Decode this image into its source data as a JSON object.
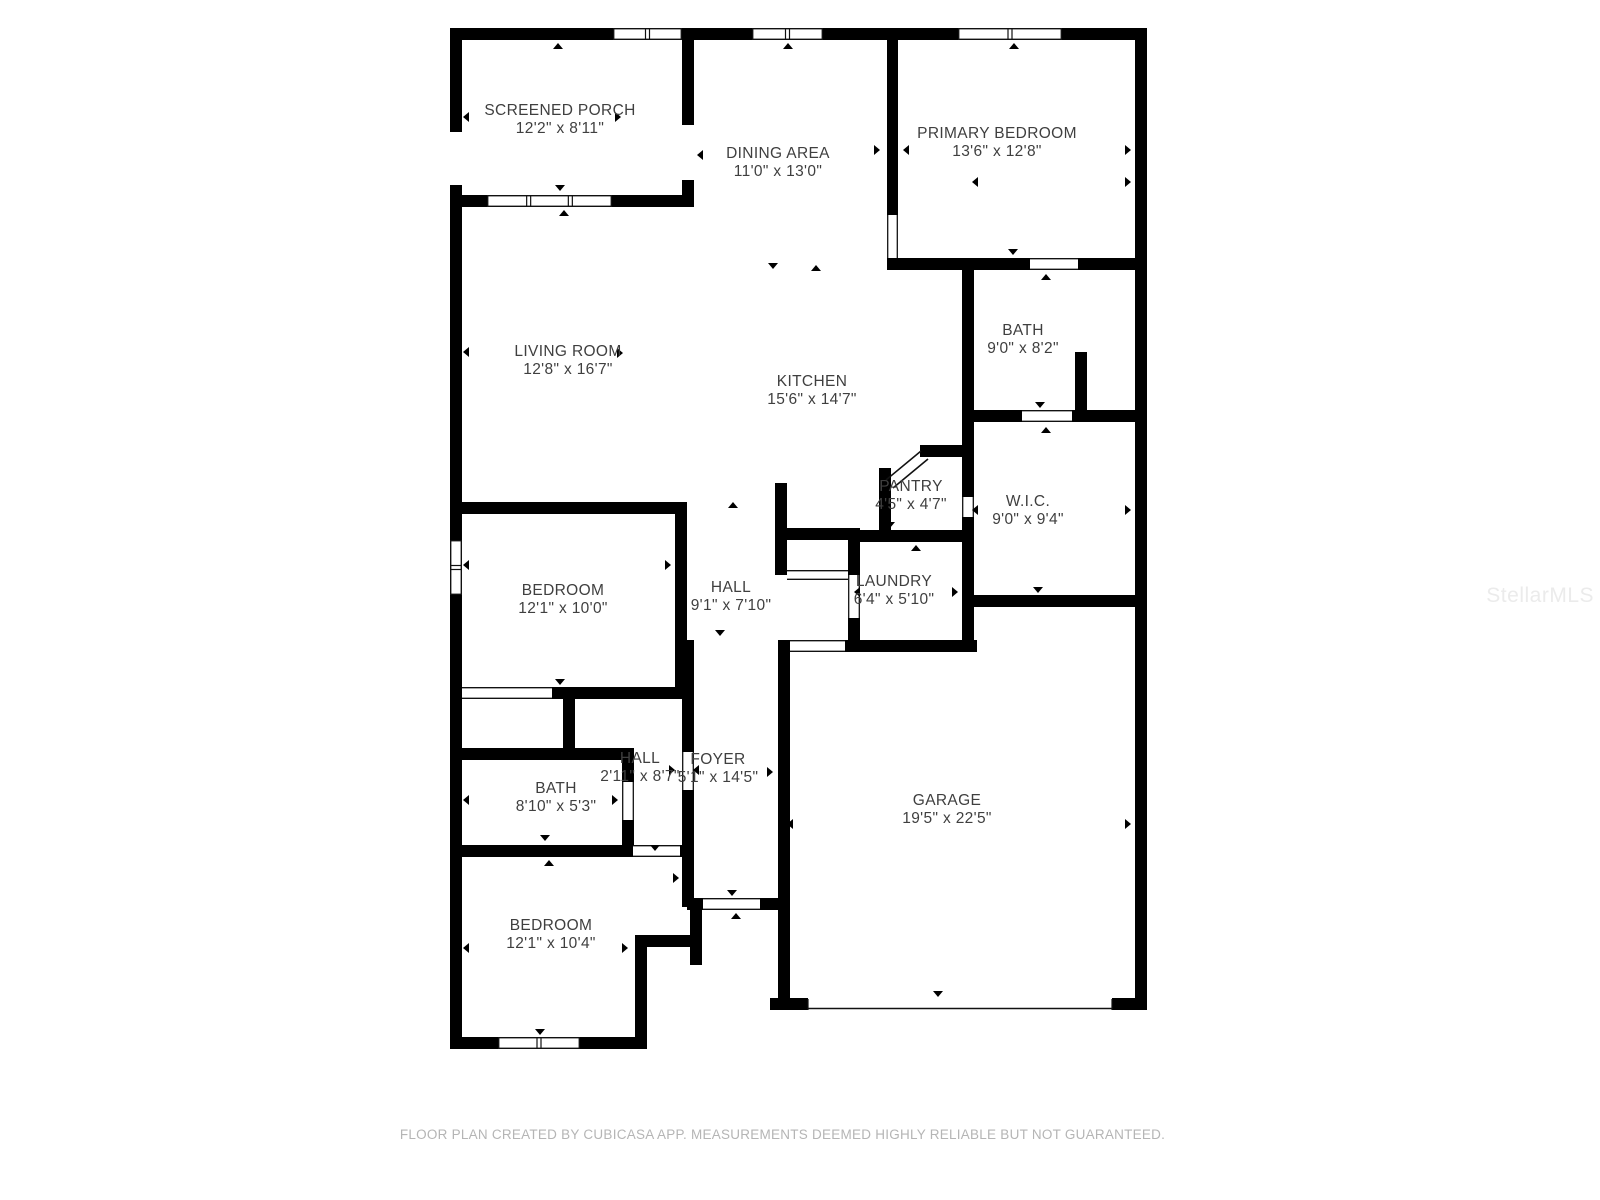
{
  "page": {
    "background": "#ffffff"
  },
  "footer": {
    "text": "FLOOR PLAN CREATED BY CUBICASA APP. MEASUREMENTS DEEMED HIGHLY RELIABLE BUT NOT GUARANTEED."
  },
  "watermark": {
    "text": "StellarMLS"
  },
  "colors": {
    "wall": "#000000",
    "label": "#3f3f3f",
    "opening_line": "#111111",
    "footer": "#b5b5b5",
    "watermark": "#ebebeb",
    "background": "#ffffff"
  },
  "floorplan": {
    "canvas": {
      "w": 1600,
      "h": 1200
    },
    "rooms": [
      {
        "id": "screened-porch",
        "name": "SCREENED PORCH",
        "dims": "12'2\" x 8'11\"",
        "x": 560,
        "y": 110
      },
      {
        "id": "dining-area",
        "name": "DINING AREA",
        "dims": "11'0\" x 13'0\"",
        "x": 778,
        "y": 153
      },
      {
        "id": "primary-bedroom",
        "name": "PRIMARY BEDROOM",
        "dims": "13'6\" x 12'8\"",
        "x": 997,
        "y": 133
      },
      {
        "id": "living-room",
        "name": "LIVING ROOM",
        "dims": "12'8\" x 16'7\"",
        "x": 568,
        "y": 351
      },
      {
        "id": "kitchen",
        "name": "KITCHEN",
        "dims": "15'6\" x 14'7\"",
        "x": 812,
        "y": 381
      },
      {
        "id": "bath-1",
        "name": "BATH",
        "dims": "9'0\" x 8'2\"",
        "x": 1023,
        "y": 330
      },
      {
        "id": "pantry",
        "name": "PANTRY",
        "dims": "4'5\" x 4'7\"",
        "x": 911,
        "y": 486
      },
      {
        "id": "wic",
        "name": "W.I.C.",
        "dims": "9'0\" x 9'4\"",
        "x": 1028,
        "y": 501
      },
      {
        "id": "bedroom-1",
        "name": "BEDROOM",
        "dims": "12'1\" x 10'0\"",
        "x": 563,
        "y": 590
      },
      {
        "id": "hall-1",
        "name": "HALL",
        "dims": "9'1\" x 7'10\"",
        "x": 731,
        "y": 587
      },
      {
        "id": "laundry",
        "name": "LAUNDRY",
        "dims": "6'4\" x 5'10\"",
        "x": 894,
        "y": 581
      },
      {
        "id": "hall-2",
        "name": "HALL",
        "dims": "2'11\" x 8'7\"",
        "x": 640,
        "y": 758
      },
      {
        "id": "foyer",
        "name": "FOYER",
        "dims": "5'1\" x 14'5\"",
        "x": 718,
        "y": 759
      },
      {
        "id": "bath-2",
        "name": "BATH",
        "dims": "8'10\" x 5'3\"",
        "x": 556,
        "y": 788
      },
      {
        "id": "garage",
        "name": "GARAGE",
        "dims": "19'5\" x 22'5\"",
        "x": 947,
        "y": 800
      },
      {
        "id": "bedroom-2",
        "name": "BEDROOM",
        "dims": "12'1\" x 10'4\"",
        "x": 551,
        "y": 925
      }
    ],
    "walls": [
      [
        450,
        28,
        697,
        12
      ],
      [
        450,
        28,
        12,
        1021
      ],
      [
        1135,
        28,
        12,
        982
      ],
      [
        770,
        998,
        377,
        12
      ],
      [
        450,
        1037,
        197,
        12
      ],
      [
        682,
        28,
        12,
        177
      ],
      [
        450,
        195,
        244,
        12
      ],
      [
        887,
        28,
        11,
        242
      ],
      [
        887,
        258,
        260,
        12
      ],
      [
        962,
        258,
        12,
        394
      ],
      [
        962,
        410,
        185,
        12
      ],
      [
        1075,
        352,
        12,
        70
      ],
      [
        962,
        595,
        185,
        12
      ],
      [
        879,
        468,
        12,
        74
      ],
      [
        920,
        445,
        54,
        12
      ],
      [
        848,
        530,
        126,
        12
      ],
      [
        848,
        530,
        12,
        122
      ],
      [
        845,
        640,
        132,
        12
      ],
      [
        775,
        483,
        12,
        92
      ],
      [
        787,
        528,
        73,
        12
      ],
      [
        778,
        640,
        12,
        370
      ],
      [
        450,
        502,
        237,
        12
      ],
      [
        675,
        502,
        12,
        197
      ],
      [
        552,
        687,
        135,
        12
      ],
      [
        563,
        699,
        12,
        49
      ],
      [
        450,
        748,
        184,
        12
      ],
      [
        622,
        748,
        12,
        109
      ],
      [
        450,
        845,
        244,
        12
      ],
      [
        682,
        640,
        12,
        267
      ],
      [
        635,
        935,
        12,
        114
      ],
      [
        647,
        935,
        47,
        12
      ],
      [
        687,
        898,
        103,
        12
      ],
      [
        690,
        910,
        12,
        55
      ]
    ],
    "windows": [
      [
        613,
        28,
        69,
        12,
        1
      ],
      [
        752,
        28,
        71,
        12,
        1
      ],
      [
        958,
        28,
        104,
        12,
        1
      ],
      [
        487,
        195,
        125,
        12,
        2
      ],
      [
        450,
        540,
        12,
        55,
        1
      ],
      [
        498,
        1037,
        82,
        12,
        1
      ]
    ],
    "gaps": [
      [
        450,
        132,
        12,
        53
      ],
      [
        682,
        125,
        12,
        55
      ]
    ],
    "cased_openings": [
      [
        887,
        215,
        11,
        43
      ],
      [
        1030,
        258,
        48,
        12
      ],
      [
        1022,
        410,
        50,
        12
      ],
      [
        962,
        497,
        12,
        20
      ],
      [
        848,
        575,
        12,
        43
      ],
      [
        787,
        570,
        61,
        10
      ],
      [
        790,
        640,
        55,
        12
      ],
      [
        462,
        687,
        90,
        12
      ],
      [
        622,
        782,
        12,
        38
      ],
      [
        682,
        752,
        12,
        38
      ],
      [
        633,
        845,
        47,
        12
      ],
      [
        703,
        898,
        57,
        12
      ]
    ],
    "garage_door": [
      808,
      998,
      304,
      12
    ],
    "diagonal_door": [
      [
        886,
        480,
        921,
        451
      ],
      [
        893,
        488,
        928,
        459
      ]
    ],
    "markers": [
      [
        558,
        46,
        "u"
      ],
      [
        560,
        188,
        "d"
      ],
      [
        466,
        117,
        "l"
      ],
      [
        618,
        117,
        "r"
      ],
      [
        564,
        213,
        "u"
      ],
      [
        788,
        46,
        "u"
      ],
      [
        700,
        155,
        "l"
      ],
      [
        877,
        150,
        "r"
      ],
      [
        773,
        266,
        "d"
      ],
      [
        816,
        268,
        "u"
      ],
      [
        1014,
        46,
        "u"
      ],
      [
        1128,
        150,
        "r"
      ],
      [
        906,
        150,
        "l"
      ],
      [
        1013,
        252,
        "d"
      ],
      [
        1046,
        277,
        "u"
      ],
      [
        975,
        182,
        "l"
      ],
      [
        1128,
        182,
        "r"
      ],
      [
        1040,
        405,
        "d"
      ],
      [
        1046,
        430,
        "u"
      ],
      [
        975,
        510,
        "l"
      ],
      [
        1128,
        510,
        "r"
      ],
      [
        1038,
        590,
        "d"
      ],
      [
        940,
        452,
        "u"
      ],
      [
        890,
        525,
        "d"
      ],
      [
        916,
        548,
        "u"
      ],
      [
        857,
        592,
        "l"
      ],
      [
        955,
        592,
        "r"
      ],
      [
        912,
        647,
        "d"
      ],
      [
        466,
        352,
        "l"
      ],
      [
        620,
        353,
        "r"
      ],
      [
        560,
        509,
        "u"
      ],
      [
        466,
        565,
        "l"
      ],
      [
        668,
        565,
        "r"
      ],
      [
        560,
        682,
        "d"
      ],
      [
        733,
        505,
        "u"
      ],
      [
        660,
        505,
        "u"
      ],
      [
        720,
        633,
        "d"
      ],
      [
        676,
        878,
        "r"
      ],
      [
        672,
        770,
        "r"
      ],
      [
        696,
        770,
        "l"
      ],
      [
        770,
        772,
        "r"
      ],
      [
        732,
        893,
        "d"
      ],
      [
        736,
        916,
        "u"
      ],
      [
        543,
        752,
        "d"
      ],
      [
        545,
        838,
        "d"
      ],
      [
        549,
        863,
        "u"
      ],
      [
        466,
        800,
        "l"
      ],
      [
        615,
        800,
        "r"
      ],
      [
        655,
        848,
        "d"
      ],
      [
        466,
        948,
        "l"
      ],
      [
        625,
        948,
        "r"
      ],
      [
        540,
        1032,
        "d"
      ],
      [
        790,
        824,
        "l"
      ],
      [
        1128,
        824,
        "r"
      ],
      [
        1053,
        601,
        "u"
      ],
      [
        938,
        994,
        "d"
      ]
    ]
  }
}
